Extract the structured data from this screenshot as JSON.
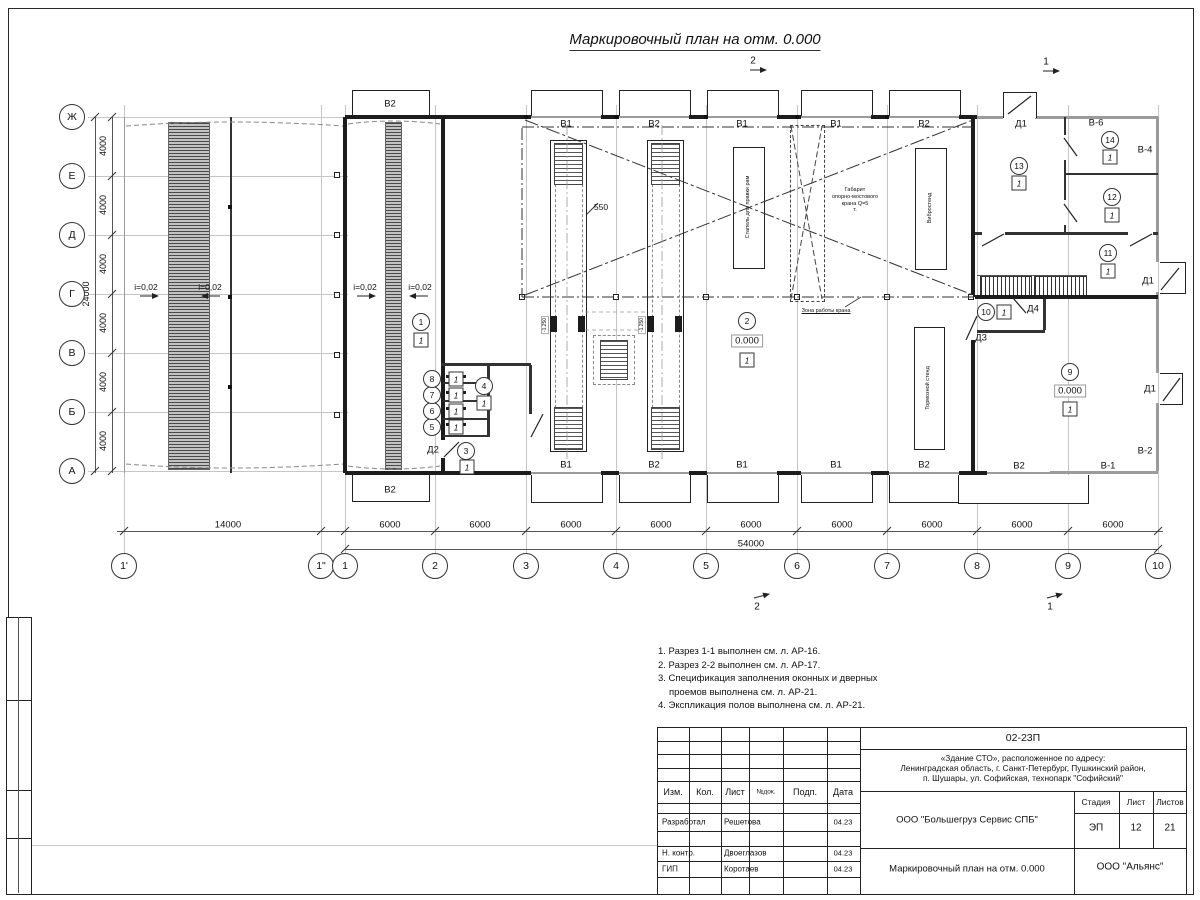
{
  "sheet": {
    "title": "Маркировочный план на отм. 0.000"
  },
  "markers": {
    "top_a": "2",
    "top_b": "1",
    "bot_a": "2",
    "bot_b": "1"
  },
  "axes": {
    "letters": [
      "Ж",
      "Е",
      "Д",
      "Г",
      "В",
      "Б",
      "А"
    ],
    "numbers": [
      "1'",
      "1\"",
      "1",
      "2",
      "3",
      "4",
      "5",
      "6",
      "7",
      "8",
      "9",
      "10"
    ],
    "dim_4000": "4000",
    "dim_total_v": "24000",
    "dim_14000": "14000",
    "dim_6000": "6000",
    "dim_total_h": "54000"
  },
  "plan": {
    "slope": "i=0,02",
    "gates_top": [
      "В2",
      "В1",
      "В2",
      "В1",
      "В1",
      "В2"
    ],
    "gates_bottom": [
      "В2",
      "В1",
      "В2",
      "В1",
      "В1",
      "В2",
      "В2"
    ],
    "windows": {
      "v6": "В-6",
      "v4": "В-4",
      "v2": "В-2",
      "v1": "В-1"
    },
    "doors": {
      "d1": "Д1",
      "d2": "Д2",
      "d3": "Д3",
      "d4": "Д4"
    },
    "rooms": [
      "1",
      "2",
      "3",
      "4",
      "5",
      "6",
      "7",
      "8",
      "9",
      "10",
      "11",
      "12",
      "13",
      "14"
    ],
    "floor_mark": "1",
    "level_zero": "0.000",
    "pit_level": "-1.250",
    "dim_550": "550",
    "crane": {
      "l1": "Габарит",
      "l2": "опорно-мостового",
      "l3": "крана Q=5",
      "l4": "т."
    },
    "crane_zone": "Зона работы крана",
    "equipment": {
      "stapel": "Стапель для правки рам",
      "vibro": "Вибростенд",
      "tormoz": "Тормозной стенд"
    }
  },
  "notes": [
    "1. Разрез 1-1 выполнен см. л. АР-16.",
    "2. Разрез 2-2 выполнен см. л. АР-17.",
    "3. Спецификация заполнения оконных и дверных",
    "проемов выполнена см. л. АР-21.",
    "4. Экспликация полов выполнена см. л. АР-21."
  ],
  "title_block": {
    "code": "02-23П",
    "object_line1": "«Здание СТО», расположенное по адресу:",
    "object_line2": "Ленинградская область, г. Санкт-Петербург, Пушкинский район,",
    "object_line3": "п. Шушары, ул. Софийская, технопарк \"Софийский\"",
    "org": "ООО \"Большегруз Сервис СПБ\"",
    "doc_title": "Маркировочный план на отм. 0.000",
    "company": "ООО \"Альянс\"",
    "stage_label": "Стадия",
    "sheet_label": "Лист",
    "sheets_label": "Листов",
    "stage": "ЭП",
    "sheet_no": "12",
    "sheets_total": "21",
    "cols": [
      "Изм.",
      "Кол.",
      "Лист",
      "№док.",
      "Подп.",
      "Дата"
    ],
    "rows": [
      {
        "role": "Разработал",
        "name": "Решетова",
        "date": "04.23"
      },
      {
        "role": "Н. контр.",
        "name": "Двоеглазов",
        "date": "04.23"
      },
      {
        "role": "ГИП",
        "name": "Коротаев",
        "date": "04.23"
      }
    ]
  }
}
